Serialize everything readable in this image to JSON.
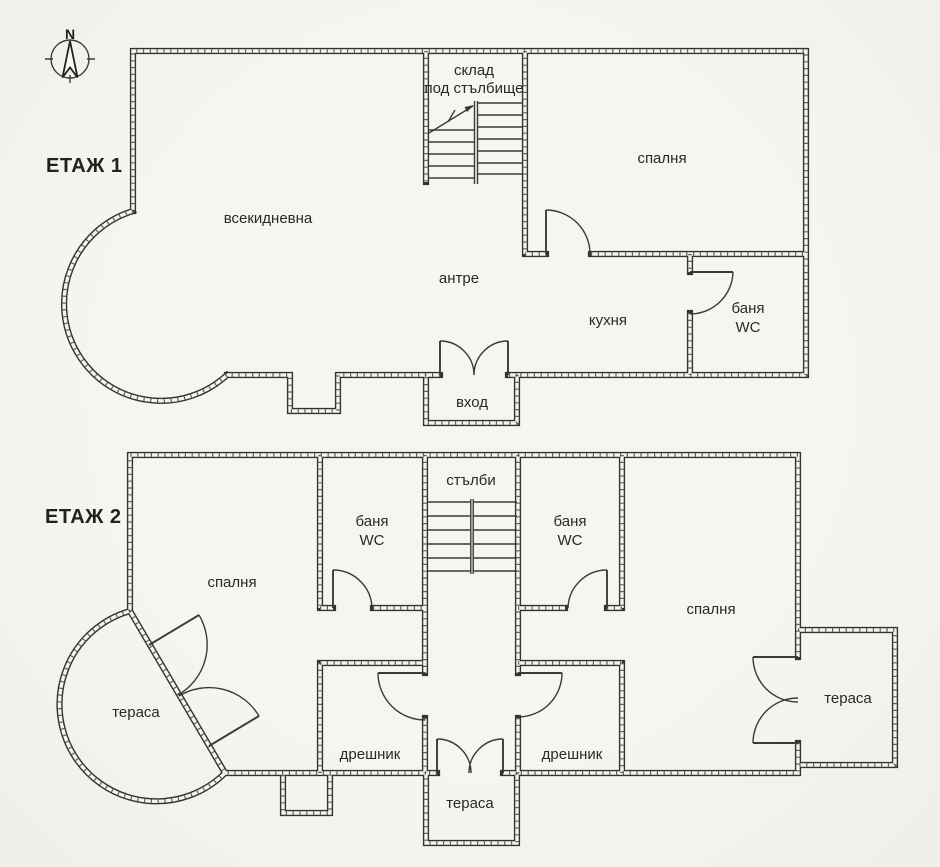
{
  "meta": {
    "type": "architectural floor plan, two storeys, scanned line drawing",
    "language": "Bulgarian"
  },
  "colors": {
    "background": "#f6f5f1",
    "line": "#35332f",
    "text": "#2b2926"
  },
  "compass": {
    "north_label": "N"
  },
  "floor1": {
    "title": "ЕТАЖ 1",
    "rooms": {
      "storage_line1": "склад",
      "storage_line2": "под стълбище",
      "bedroom": "спалня",
      "living": "всекидневна",
      "hall": "антре",
      "kitchen": "кухня",
      "bath_line1": "баня",
      "bath_line2": "WC",
      "entrance": "вход"
    }
  },
  "floor2": {
    "title": "ЕТАЖ 2",
    "rooms": {
      "stairs": "стълби",
      "bath_left_line1": "баня",
      "bath_left_line2": "WC",
      "bath_right_line1": "баня",
      "bath_right_line2": "WC",
      "bedroom_left": "спалня",
      "bedroom_right": "спалня",
      "closet_left": "дрешник",
      "closet_right": "дрешник",
      "terrace_left": "тераса",
      "terrace_right": "тераса",
      "terrace_bottom": "тераса"
    }
  }
}
